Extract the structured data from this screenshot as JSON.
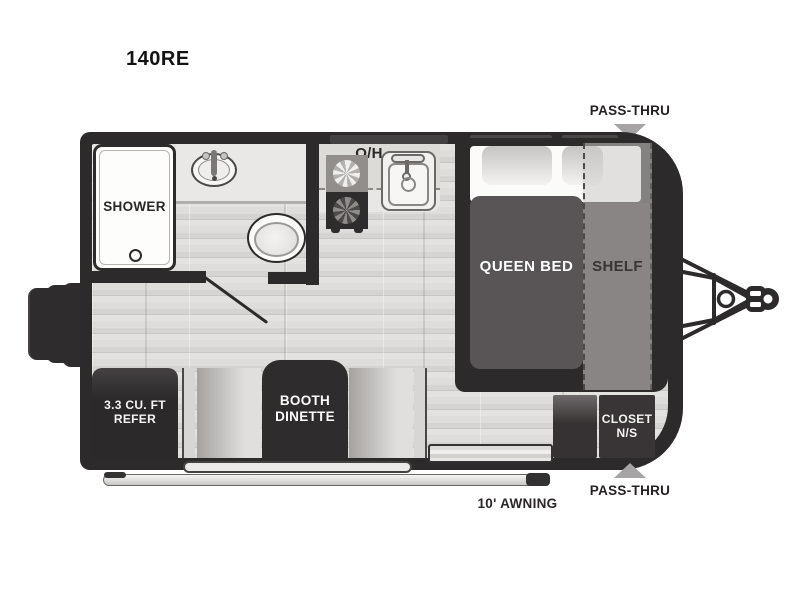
{
  "model": "140RE",
  "exterior": {
    "pass_thru_top": "PASS-THRU",
    "pass_thru_bottom": "PASS-THRU",
    "awning": "10' AWNING"
  },
  "rooms": {
    "shower": "SHOWER",
    "overhead": "O/H",
    "queen_bed": "QUEEN BED",
    "shelf": "SHELF",
    "refer": [
      "3.3 CU. FT",
      "REFER"
    ],
    "dinette": [
      "BOOTH",
      "DINETTE"
    ],
    "closet": [
      "CLOSET",
      "N/S"
    ]
  },
  "colors": {
    "wall": "#2d2a2b",
    "floor": "#dcdbd9",
    "bed": "#595556",
    "shelf": "#969391",
    "arrow_gray": "#a6a4a4"
  }
}
